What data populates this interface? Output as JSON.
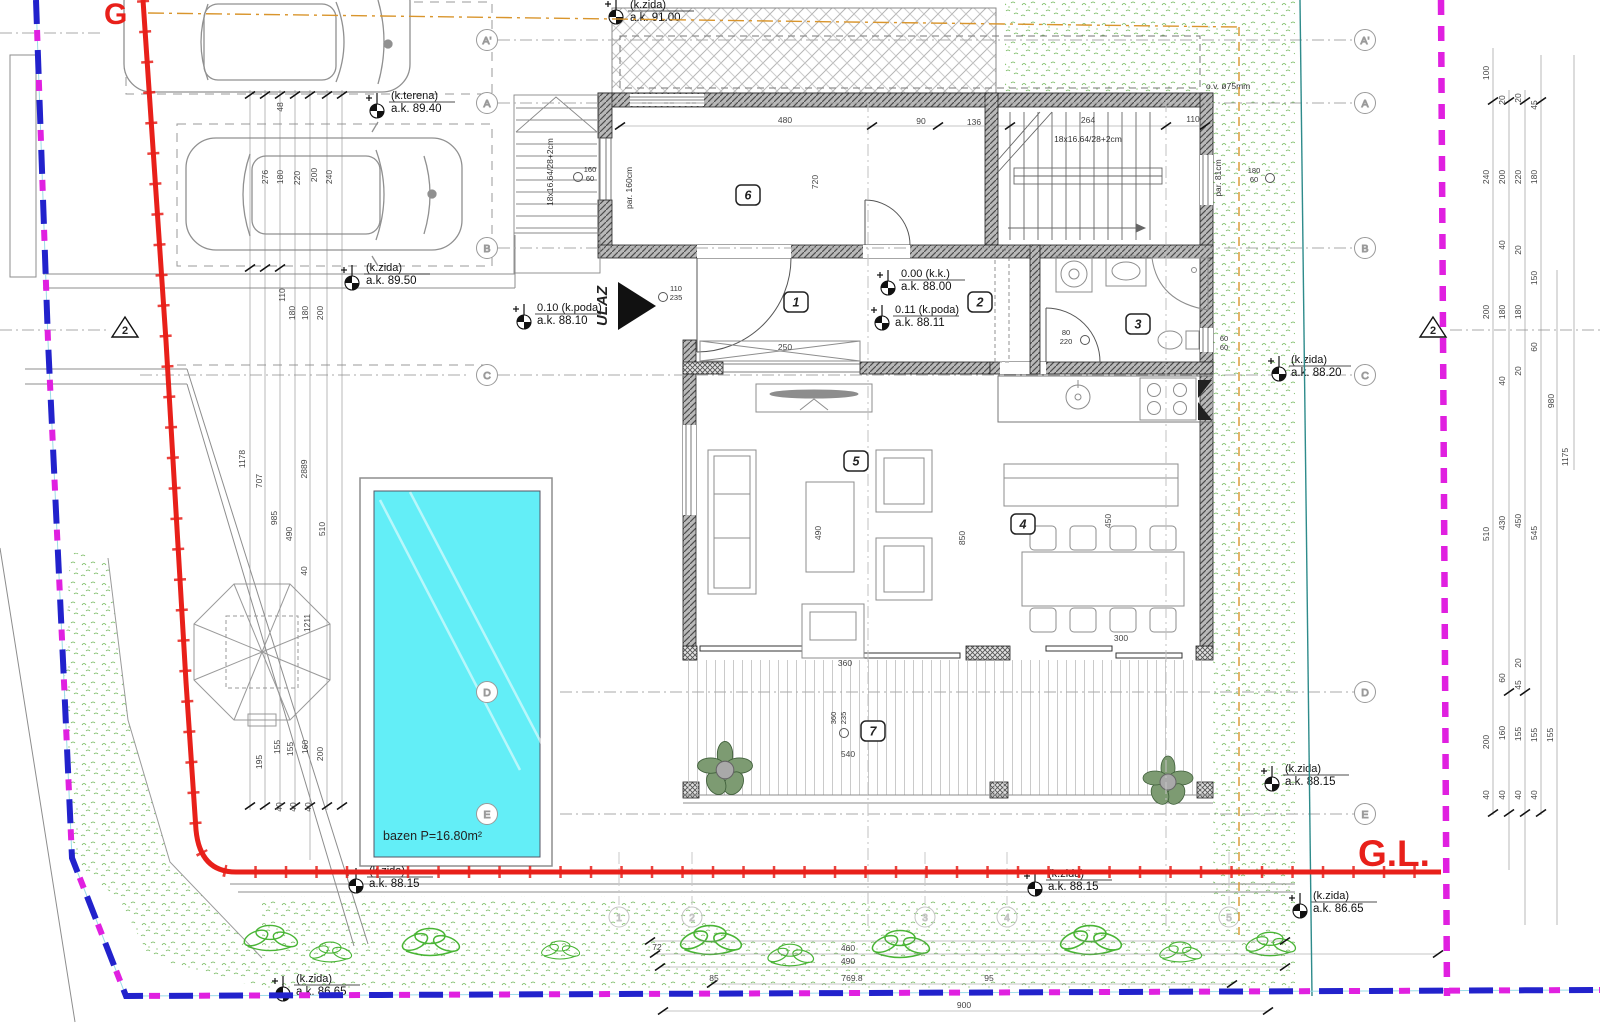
{
  "scene": {
    "gl": "G.L.",
    "g": "G",
    "ulaz": "ULAZ",
    "pool": "bazen P=16.80m²"
  },
  "grid": {
    "letters": [
      "A'",
      "A",
      "B",
      "C",
      "D",
      "E"
    ],
    "numbers": [
      "1",
      "2",
      "3",
      "4",
      "5"
    ],
    "section": "2"
  },
  "rooms": [
    "1",
    "2",
    "3",
    "4",
    "5",
    "6",
    "7"
  ],
  "markers": [
    {
      "l1": "(k.terena)",
      "l2": "a.k. 89.40"
    },
    {
      "l1": "(k.zida)",
      "l2": "a.k. 89.50"
    },
    {
      "l1": "(k.zida)",
      "l2": "a.k. 91.00"
    },
    {
      "l1": "0.10 (k.poda)",
      "l2": "a.k. 88.10"
    },
    {
      "l1": "0.00 (k.k.)",
      "l2": "a.k. 88.00"
    },
    {
      "l1": "0.11 (k.poda)",
      "l2": "a.k. 88.11"
    },
    {
      "l1": "(k.zida)",
      "l2": "a.k. 88.20"
    },
    {
      "l1": "(k.zida)",
      "l2": "a.k. 88.15"
    },
    {
      "l1": "(k.zida)",
      "l2": "a.k. 88.15"
    },
    {
      "l1": "(k.zida)",
      "l2": "a.k. 88.15"
    },
    {
      "l1": "(k.zida)",
      "l2": "a.k. 86.65"
    },
    {
      "l1": "(k.zida)",
      "l2": "a.k. 86.65"
    }
  ],
  "openings": [
    {
      "w": "160",
      "h": "60"
    },
    {
      "w": "110",
      "h": "235"
    },
    {
      "w": "80",
      "h": "220"
    },
    {
      "w": "360",
      "h": "235"
    },
    {
      "w": "180",
      "h": "60"
    },
    {
      "w": "60",
      "h": "60"
    }
  ],
  "notes": {
    "drain": "o.v. ø75mm",
    "stairs": "18x16.64/28+2cm",
    "par_left": "par. 160cm",
    "par_right": "par. 81cm"
  },
  "dims": {
    "left": [
      "48",
      "276",
      "180",
      "220",
      "200",
      "240",
      "110",
      "180",
      "180",
      "200",
      "1178",
      "707",
      "985",
      "490",
      "2889",
      "510",
      "40",
      "1211",
      "195",
      "155",
      "155",
      "160",
      "200",
      "40",
      "40",
      "40"
    ],
    "right": [
      "100",
      "20",
      "20",
      "45",
      "240",
      "200",
      "220",
      "180",
      "40",
      "20",
      "150",
      "200",
      "180",
      "180",
      "60",
      "40",
      "20",
      "980",
      "1175",
      "510",
      "430",
      "450",
      "545",
      "60",
      "45",
      "20",
      "200",
      "160",
      "155",
      "155",
      "155",
      "40",
      "40",
      "40",
      "40"
    ],
    "top": [
      "480",
      "90",
      "136",
      "264",
      "110",
      "720"
    ],
    "bottom": [
      "72",
      "460",
      "490",
      "85",
      "769.8",
      "95",
      "900"
    ],
    "inner": [
      "490",
      "850",
      "450",
      "300",
      "540",
      "250",
      "360"
    ]
  },
  "colors": {
    "boundary_red": "#e8201a",
    "boundary_blue": "#2222cc",
    "boundary_magenta": "#e020e0",
    "offset_orange": "#d9952c",
    "utility_teal": "#2e8b8b",
    "pool_water": "#63eef7",
    "grass_green": "#5fae46"
  }
}
